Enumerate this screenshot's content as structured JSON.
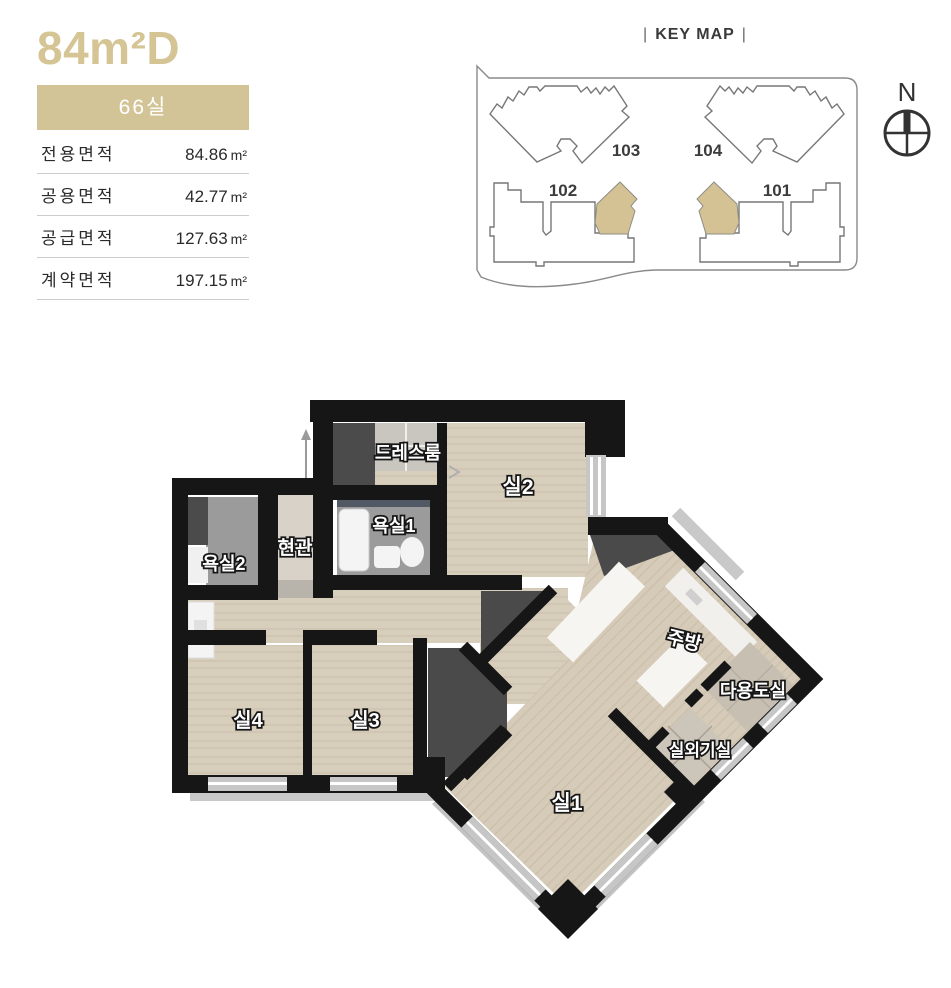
{
  "unit": {
    "title": "84m²D",
    "badge": "66실",
    "accent_color": "#d2c496",
    "area_table": {
      "rows": [
        {
          "label": "전용면적",
          "value": "84.86",
          "unit": "m²"
        },
        {
          "label": "공용면적",
          "value": "42.77",
          "unit": "m²"
        },
        {
          "label": "공급면적",
          "value": "127.63",
          "unit": "m²"
        },
        {
          "label": "계약면적",
          "value": "197.15",
          "unit": "m²"
        }
      ]
    }
  },
  "key_map": {
    "title": "KEY MAP",
    "bar": "|",
    "compass": "N",
    "highlight_color": "#d4c194",
    "buildings": [
      {
        "number": "103"
      },
      {
        "number": "104"
      },
      {
        "number": "102"
      },
      {
        "number": "101"
      }
    ]
  },
  "floor_plan": {
    "rooms": {
      "dress_room": "드레스룸",
      "room2": "실2",
      "bath1": "욕실1",
      "entrance": "현관",
      "bath2": "욕실2",
      "room4": "실4",
      "room3": "실3",
      "room1": "실1",
      "kitchen": "주방",
      "utility_room": "다용도실",
      "ac_room": "실외기실"
    }
  }
}
